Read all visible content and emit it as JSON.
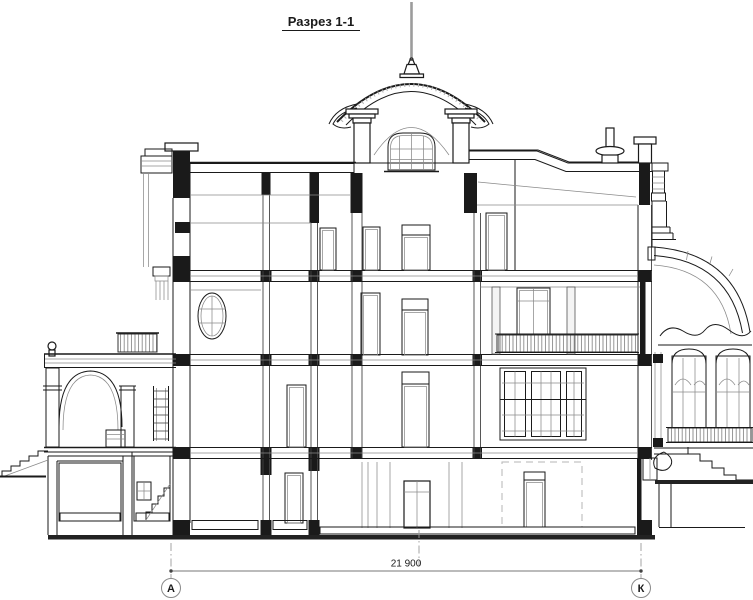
{
  "drawing": {
    "title": "Разрез 1-1",
    "kind": "architectural-building-cross-section",
    "dimension_label": "21 900",
    "axis_left": "А",
    "axis_right": "К",
    "colors": {
      "line": "#1a1a1a",
      "detail": "#8a8a8a",
      "ground": "#222222",
      "background": "#ffffff"
    }
  }
}
